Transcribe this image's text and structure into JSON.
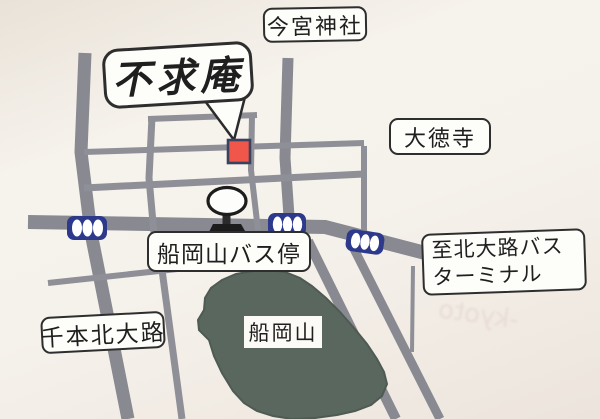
{
  "map": {
    "title_note": "hand-drawn access map",
    "labels": {
      "destination": "不求庵",
      "imamiya_shrine": "今宮神社",
      "daitokuji": "大徳寺",
      "funaokayama_bus_stop": "船岡山バス停",
      "kitaoji_terminal_line1": "至北大路バス",
      "kitaoji_terminal_line2": "ターミナル",
      "senbon_kitaoji": "千本北大路",
      "funaokayama_hill": "船岡山"
    },
    "colors": {
      "road": "#898991",
      "road_thin": "#8f8f97",
      "hill": "#59675f",
      "hill_edge": "#4e5b53",
      "marker_fill": "#f0564a",
      "marker_border": "#39425f",
      "bus_icon": "#2d3a8c",
      "paper": "#f2ede6",
      "outline": "#2e2e2e",
      "sign_dark": "#1c1c1c"
    },
    "icons": [
      "bus-icon",
      "bus-icon",
      "bus-icon",
      "bus-stop-sign-icon",
      "destination-marker"
    ],
    "artifacts": {
      "bleed_text": "-kyoto"
    }
  }
}
